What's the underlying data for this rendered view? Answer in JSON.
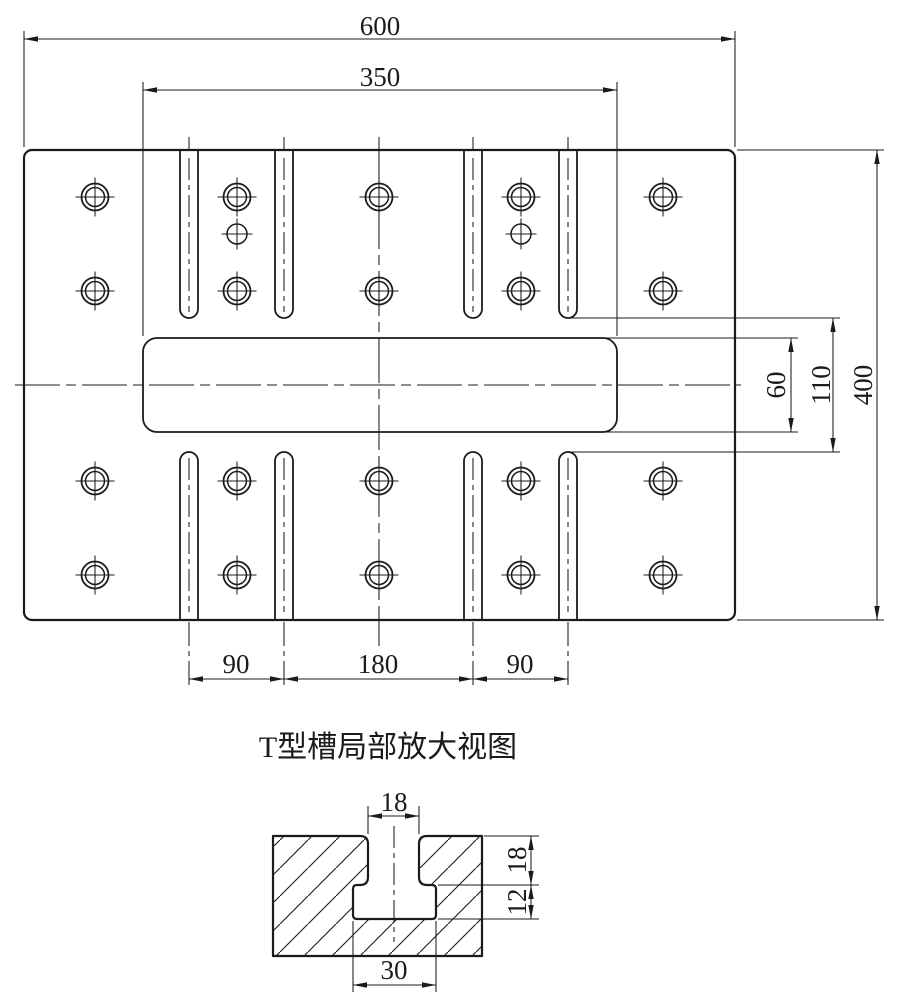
{
  "drawing": {
    "title": "T型槽局部放大视图",
    "main_view": {
      "dim_overall_width": "600",
      "dim_slot_length": "350",
      "dim_overall_height": "400",
      "dim_slot_end_gap": "110",
      "dim_central_slot_width": "60",
      "dim_tslot_pitch_left": "90",
      "dim_tslot_pitch_center": "180",
      "dim_tslot_pitch_right": "90"
    },
    "detail_view": {
      "dim_neck_width": "18",
      "dim_neck_depth": "18",
      "dim_undercut_depth": "12",
      "dim_undercut_width": "30"
    }
  }
}
